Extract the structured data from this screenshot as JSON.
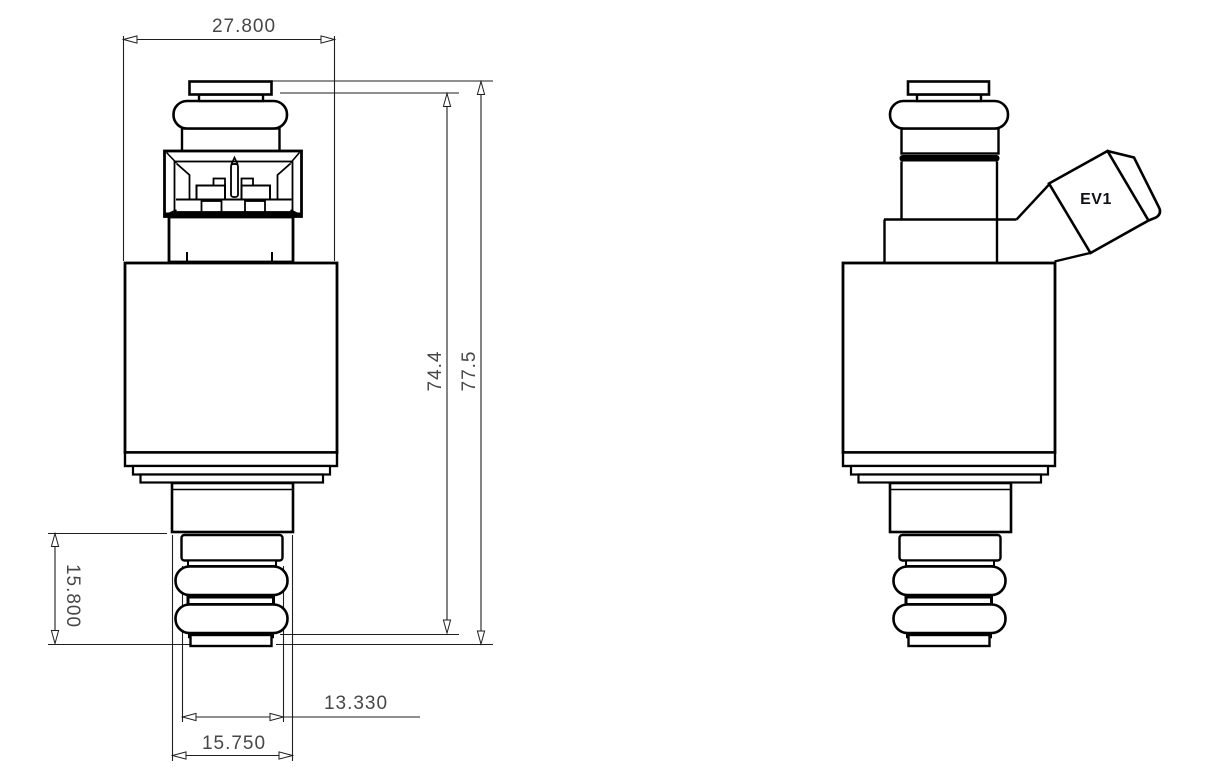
{
  "colors": {
    "ink": "#000000",
    "dimension_ink": "#474747"
  },
  "dimensions": {
    "body_width": "27.800",
    "shoulder_height": "74.4",
    "overall_length": "77.5",
    "lower_section_height": "15.800",
    "tip_diameter": "13.330",
    "seal_diameter": "15.750"
  },
  "side_view": {
    "connector_label": "EV1"
  }
}
